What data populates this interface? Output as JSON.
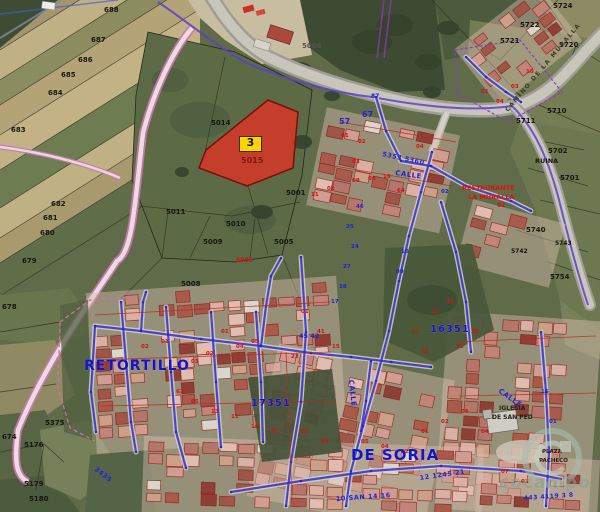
{
  "app": {
    "type": "cadastral aerial map viewer",
    "watermark": "cocampo"
  },
  "colors": {
    "badge_yellow": "#ffd400",
    "parcel_highlight": "#dd3427",
    "overlay_blue": "#2a2ad0",
    "road_pink": "#c86aab",
    "cadastral_red": "#cc1a1a",
    "town_label_blue": "#1414c8"
  },
  "highlighted_parcel": {
    "badge": "3",
    "parcel_number": "5015"
  },
  "town": {
    "name_line1": "RETORTILLO",
    "name_line2": "DE SORIA"
  },
  "map_labels": [
    {
      "t": "688",
      "x": 104,
      "y": 12,
      "c": "k",
      "s": 7
    },
    {
      "t": "687",
      "x": 91,
      "y": 42,
      "c": "k",
      "s": 7
    },
    {
      "t": "686",
      "x": 78,
      "y": 62,
      "c": "k",
      "s": 7
    },
    {
      "t": "685",
      "x": 61,
      "y": 77,
      "c": "k",
      "s": 7
    },
    {
      "t": "684",
      "x": 48,
      "y": 95,
      "c": "k",
      "s": 7
    },
    {
      "t": "683",
      "x": 11,
      "y": 132,
      "c": "k",
      "s": 7
    },
    {
      "t": "682",
      "x": 51,
      "y": 206,
      "c": "k",
      "s": 7
    },
    {
      "t": "681",
      "x": 43,
      "y": 220,
      "c": "k",
      "s": 7
    },
    {
      "t": "680",
      "x": 40,
      "y": 235,
      "c": "k",
      "s": 7
    },
    {
      "t": "679",
      "x": 22,
      "y": 263,
      "c": "k",
      "s": 7
    },
    {
      "t": "678",
      "x": 2,
      "y": 309,
      "c": "k",
      "s": 7
    },
    {
      "t": "674",
      "x": 2,
      "y": 439,
      "c": "k",
      "s": 7
    },
    {
      "t": "5375",
      "x": 45,
      "y": 425,
      "c": "k",
      "s": 7
    },
    {
      "t": "5176",
      "x": 24,
      "y": 447,
      "c": "k",
      "s": 7
    },
    {
      "t": "5179",
      "x": 24,
      "y": 486,
      "c": "k",
      "s": 7
    },
    {
      "t": "5180",
      "x": 29,
      "y": 501,
      "c": "k",
      "s": 7
    },
    {
      "t": "5008",
      "x": 181,
      "y": 286,
      "c": "k",
      "s": 7
    },
    {
      "t": "5011",
      "x": 166,
      "y": 214,
      "c": "k",
      "s": 7
    },
    {
      "t": "5010",
      "x": 226,
      "y": 226,
      "c": "k",
      "s": 7
    },
    {
      "t": "5009",
      "x": 203,
      "y": 244,
      "c": "k",
      "s": 7
    },
    {
      "t": "5005",
      "x": 274,
      "y": 244,
      "c": "k",
      "s": 7
    },
    {
      "t": "5001",
      "x": 286,
      "y": 195,
      "c": "k",
      "s": 7
    },
    {
      "t": "5014",
      "x": 211,
      "y": 125,
      "c": "k",
      "s": 7
    },
    {
      "t": "5724",
      "x": 553,
      "y": 8,
      "c": "k",
      "s": 7
    },
    {
      "t": "5722",
      "x": 520,
      "y": 27,
      "c": "k",
      "s": 7
    },
    {
      "t": "5721",
      "x": 500,
      "y": 43,
      "c": "k",
      "s": 7
    },
    {
      "t": "5720",
      "x": 559,
      "y": 47,
      "c": "k",
      "s": 7
    },
    {
      "t": "5710",
      "x": 547,
      "y": 113,
      "c": "k",
      "s": 7
    },
    {
      "t": "5711",
      "x": 516,
      "y": 123,
      "c": "k",
      "s": 7
    },
    {
      "t": "5702",
      "x": 548,
      "y": 153,
      "c": "k",
      "s": 7
    },
    {
      "t": "5701",
      "x": 560,
      "y": 180,
      "c": "k",
      "s": 7
    },
    {
      "t": "5740",
      "x": 526,
      "y": 232,
      "c": "k",
      "s": 7
    },
    {
      "t": "5754",
      "x": 550,
      "y": 279,
      "c": "k",
      "s": 7
    },
    {
      "t": "5742",
      "x": 511,
      "y": 253,
      "c": "k",
      "s": 6
    },
    {
      "t": "5743",
      "x": 555,
      "y": 245,
      "c": "k",
      "s": 6
    },
    {
      "t": "RUINA",
      "x": 535,
      "y": 163,
      "c": "k",
      "s": 6.5
    },
    {
      "t": "5006",
      "x": 302,
      "y": 48,
      "c": "kg",
      "s": 7
    },
    {
      "t": "5015",
      "x": 241,
      "y": 163,
      "c": "rd",
      "s": 8
    },
    {
      "t": "5006",
      "x": 236,
      "y": 262,
      "c": "r",
      "s": 6
    },
    {
      "t": "11",
      "x": 311,
      "y": 196,
      "c": "r",
      "s": 5.5
    },
    {
      "t": "02",
      "x": 327,
      "y": 190,
      "c": "r",
      "s": 5.5
    },
    {
      "t": "09",
      "x": 352,
      "y": 182,
      "c": "r",
      "s": 5.5
    },
    {
      "t": "08",
      "x": 368,
      "y": 180,
      "c": "r",
      "s": 5.5
    },
    {
      "t": "16",
      "x": 383,
      "y": 178,
      "c": "r",
      "s": 5.5
    },
    {
      "t": "03",
      "x": 352,
      "y": 163,
      "c": "r",
      "s": 5.5
    },
    {
      "t": "64",
      "x": 397,
      "y": 192,
      "c": "r",
      "s": 5.5
    },
    {
      "t": "01",
      "x": 341,
      "y": 137,
      "c": "r",
      "s": 5.5
    },
    {
      "t": "02",
      "x": 358,
      "y": 143,
      "c": "r",
      "s": 5.5
    },
    {
      "t": "04",
      "x": 416,
      "y": 148,
      "c": "r",
      "s": 5.5
    },
    {
      "t": "01",
      "x": 301,
      "y": 313,
      "c": "r",
      "s": 5.5
    },
    {
      "t": "41",
      "x": 317,
      "y": 333,
      "c": "r",
      "s": 5.5
    },
    {
      "t": "15",
      "x": 332,
      "y": 348,
      "c": "r",
      "s": 5.5
    },
    {
      "t": "22",
      "x": 291,
      "y": 358,
      "c": "r",
      "s": 5.5
    },
    {
      "t": "05",
      "x": 251,
      "y": 343,
      "c": "r",
      "s": 5.5
    },
    {
      "t": "04",
      "x": 236,
      "y": 348,
      "c": "r",
      "s": 5.5
    },
    {
      "t": "01",
      "x": 221,
      "y": 333,
      "c": "r",
      "s": 5.5
    },
    {
      "t": "02",
      "x": 206,
      "y": 355,
      "c": "r",
      "s": 5.5
    },
    {
      "t": "03",
      "x": 191,
      "y": 363,
      "c": "r",
      "s": 5.5
    },
    {
      "t": "01",
      "x": 161,
      "y": 343,
      "c": "r",
      "s": 5.5
    },
    {
      "t": "02",
      "x": 141,
      "y": 348,
      "c": "r",
      "s": 5.5
    },
    {
      "t": "03",
      "x": 131,
      "y": 363,
      "c": "r",
      "s": 5.5
    },
    {
      "t": "62",
      "x": 176,
      "y": 393,
      "c": "r",
      "s": 5.5
    },
    {
      "t": "05",
      "x": 191,
      "y": 403,
      "c": "r",
      "s": 5.5
    },
    {
      "t": "13",
      "x": 211,
      "y": 413,
      "c": "r",
      "s": 5.5
    },
    {
      "t": "11",
      "x": 231,
      "y": 418,
      "c": "r",
      "s": 5.5
    },
    {
      "t": "10",
      "x": 251,
      "y": 428,
      "c": "r",
      "s": 5.5
    },
    {
      "t": "01",
      "x": 271,
      "y": 433,
      "c": "r",
      "s": 5.5
    },
    {
      "t": "02",
      "x": 301,
      "y": 433,
      "c": "r",
      "s": 5.5
    },
    {
      "t": "03",
      "x": 321,
      "y": 443,
      "c": "r",
      "s": 5.5
    },
    {
      "t": "05",
      "x": 361,
      "y": 443,
      "c": "r",
      "s": 5.5
    },
    {
      "t": "04",
      "x": 381,
      "y": 448,
      "c": "r",
      "s": 5.5
    },
    {
      "t": "02",
      "x": 401,
      "y": 453,
      "c": "r",
      "s": 5.5
    },
    {
      "t": "01",
      "x": 421,
      "y": 433,
      "c": "r",
      "s": 5.5
    },
    {
      "t": "02",
      "x": 441,
      "y": 423,
      "c": "r",
      "s": 5.5
    },
    {
      "t": "05",
      "x": 461,
      "y": 413,
      "c": "r",
      "s": 5.5
    },
    {
      "t": "04",
      "x": 481,
      "y": 433,
      "c": "r",
      "s": 5.5
    },
    {
      "t": "07",
      "x": 501,
      "y": 473,
      "c": "r",
      "s": 5.5
    },
    {
      "t": "03",
      "x": 521,
      "y": 483,
      "c": "r",
      "s": 5.5
    },
    {
      "t": "26",
      "x": 471,
      "y": 333,
      "c": "r",
      "s": 5.5
    },
    {
      "t": "31",
      "x": 456,
      "y": 348,
      "c": "r",
      "s": 5.5
    },
    {
      "t": "16",
      "x": 421,
      "y": 353,
      "c": "r",
      "s": 5.5
    },
    {
      "t": "11",
      "x": 411,
      "y": 333,
      "c": "r",
      "s": 5.5
    },
    {
      "t": "12",
      "x": 431,
      "y": 313,
      "c": "r",
      "s": 5.5
    },
    {
      "t": "43",
      "x": 446,
      "y": 303,
      "c": "r",
      "s": 5.5
    },
    {
      "t": "01",
      "x": 481,
      "y": 93,
      "c": "r",
      "s": 5.5
    },
    {
      "t": "04",
      "x": 496,
      "y": 103,
      "c": "r",
      "s": 5.5
    },
    {
      "t": "03",
      "x": 511,
      "y": 88,
      "c": "r",
      "s": 5.5
    },
    {
      "t": "10",
      "x": 526,
      "y": 73,
      "c": "r",
      "s": 5.5
    },
    {
      "t": "02",
      "x": 497,
      "y": 207,
      "c": "r",
      "s": 6
    },
    {
      "t": "RESTAURANTE",
      "x": 462,
      "y": 190,
      "c": "rr",
      "s": 6.5
    },
    {
      "t": "LA MURALLA",
      "x": 468,
      "y": 199,
      "c": "rr",
      "s": 6.5
    },
    {
      "t": "46",
      "x": 356,
      "y": 208,
      "c": "b",
      "s": 5.5
    },
    {
      "t": "25",
      "x": 346,
      "y": 228,
      "c": "b",
      "s": 5.5
    },
    {
      "t": "24",
      "x": 351,
      "y": 248,
      "c": "b",
      "s": 5.5
    },
    {
      "t": "27",
      "x": 343,
      "y": 268,
      "c": "b",
      "s": 5.5
    },
    {
      "t": "18",
      "x": 339,
      "y": 288,
      "c": "b",
      "s": 5.5
    },
    {
      "t": "10",
      "x": 401,
      "y": 253,
      "c": "b",
      "s": 5.5
    },
    {
      "t": "09",
      "x": 396,
      "y": 273,
      "c": "b",
      "s": 5.5
    },
    {
      "t": "02",
      "x": 441,
      "y": 193,
      "c": "b",
      "s": 5.5
    },
    {
      "t": "17",
      "x": 331,
      "y": 303,
      "c": "b",
      "s": 5.5
    },
    {
      "t": "16",
      "x": 541,
      "y": 393,
      "c": "b",
      "s": 5.5
    },
    {
      "t": "01",
      "x": 549,
      "y": 423,
      "c": "b",
      "s": 5.5
    },
    {
      "t": "87",
      "x": 371,
      "y": 98,
      "c": "b",
      "s": 6
    },
    {
      "t": "57",
      "x": 339,
      "y": 124,
      "c": "b",
      "s": 8
    },
    {
      "t": "67",
      "x": 362,
      "y": 117,
      "c": "b",
      "s": 8
    },
    {
      "t": "45 42",
      "x": 299,
      "y": 338,
      "c": "b",
      "s": 6.5
    },
    {
      "t": "5353 5360",
      "x": 382,
      "y": 156,
      "c": "st",
      "s": 6.5,
      "r": 12
    },
    {
      "t": "3435",
      "x": 94,
      "y": 470,
      "c": "st",
      "s": 6.5,
      "r": 38
    },
    {
      "t": "10 SAN 14 16",
      "x": 336,
      "y": 501,
      "c": "st",
      "s": 6.5,
      "r": -4
    },
    {
      "t": "12 1245 21",
      "x": 420,
      "y": 480,
      "c": "st",
      "s": 6.5,
      "r": -8
    },
    {
      "t": "443 4119 3 8",
      "x": 524,
      "y": 500,
      "c": "st",
      "s": 6,
      "r": -4
    },
    {
      "t": "CALLE",
      "x": 395,
      "y": 175,
      "c": "st",
      "s": 7,
      "r": 8
    },
    {
      "t": "CALLE",
      "x": 349,
      "y": 380,
      "c": "st",
      "s": 7,
      "r": 84
    },
    {
      "t": "CALLE",
      "x": 498,
      "y": 392,
      "c": "st",
      "s": 7,
      "r": 35
    },
    {
      "t": "RETORTILLO",
      "x": 84,
      "y": 370,
      "c": "bb",
      "s": 14
    },
    {
      "t": "DE SORIA",
      "x": 351,
      "y": 460,
      "c": "bb",
      "s": 15
    },
    {
      "t": "17351",
      "x": 251,
      "y": 406,
      "c": "bb",
      "s": 10
    },
    {
      "t": "16351",
      "x": 430,
      "y": 332,
      "c": "bb",
      "s": 10
    },
    {
      "t": "CAMINO DE LA MURALLA",
      "x": 508,
      "y": 112,
      "c": "rm",
      "s": 6,
      "r": -50
    },
    {
      "t": "IGLESIA",
      "x": 499,
      "y": 410,
      "c": "ch",
      "s": 6
    },
    {
      "t": "DE SAN PED",
      "x": 492,
      "y": 419,
      "c": "ch",
      "s": 6
    },
    {
      "t": "PLAZA",
      "x": 542,
      "y": 453,
      "c": "ch",
      "s": 5.5
    },
    {
      "t": "PACHECO",
      "x": 539,
      "y": 462,
      "c": "ch",
      "s": 5.5
    }
  ]
}
